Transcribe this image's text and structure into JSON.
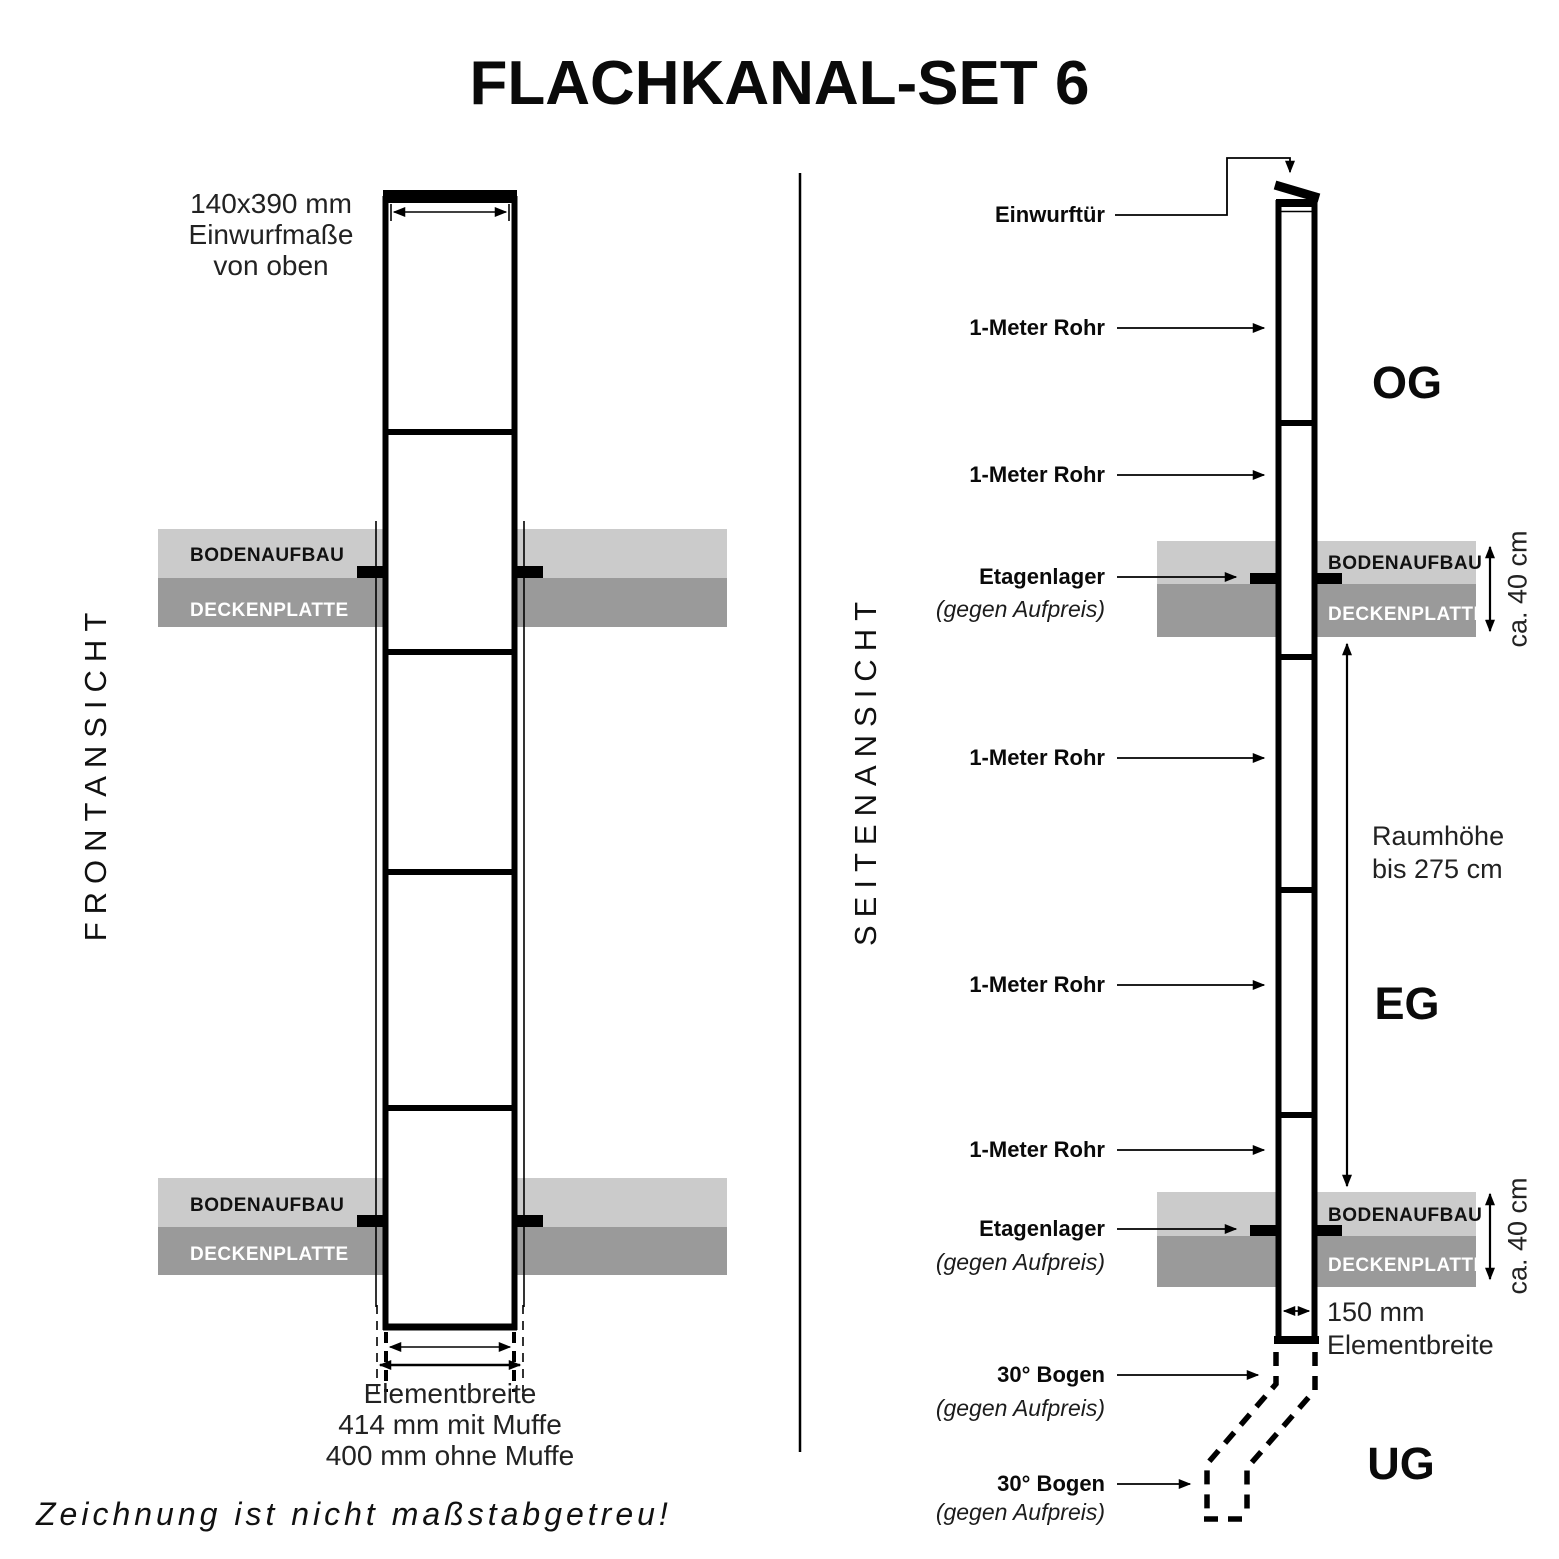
{
  "title": "FLACHKANAL-SET 6",
  "footer_note": "Zeichnung ist nicht maßstabgetreu!",
  "colors": {
    "slab_light": "#cbcbcb",
    "slab_dark": "#9a9a9a",
    "line": "#000000"
  },
  "front_view": {
    "label": "FRONTANSICHT",
    "top_annotation": {
      "line1": "140x390 mm",
      "line2": "Einwurfmaße",
      "line3": "von oben"
    },
    "bottom_annotation": {
      "line1": "Elementbreite",
      "line2": "414 mm mit Muffe",
      "line3": "400 mm ohne Muffe"
    },
    "slab": {
      "floor": "BODENAUFBAU",
      "ceiling": "DECKENPLATTE"
    }
  },
  "side_view": {
    "label": "SEITENANSICHT",
    "callouts": {
      "door": "Einwurftür",
      "pipe": "1-Meter Rohr",
      "bearing": "Etagenlager",
      "surcharge": "(gegen Aufpreis)",
      "bend": "30° Bogen"
    },
    "floors": {
      "upper": "OG",
      "ground": "EG",
      "basement": "UG"
    },
    "dimensions": {
      "slab_height": "ca. 40 cm",
      "room_height_line1": "Raumhöhe",
      "room_height_line2": "bis 275 cm",
      "element_width_line1": "150 mm",
      "element_width_line2": "Elementbreite"
    },
    "slab": {
      "floor": "BODENAUFBAU",
      "ceiling": "DECKENPLATTE"
    }
  }
}
